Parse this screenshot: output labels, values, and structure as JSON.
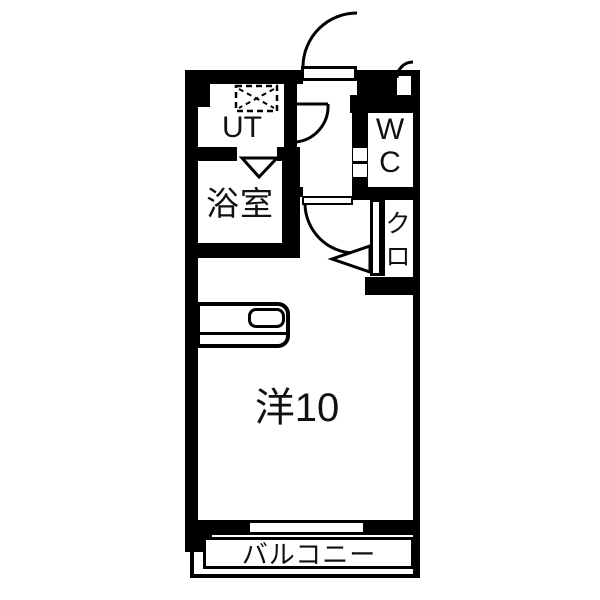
{
  "colors": {
    "wall": "#000000",
    "background": "#ffffff",
    "text": "#111111"
  },
  "rooms": {
    "utility": {
      "label": "UT"
    },
    "bathroom": {
      "label": "浴室"
    },
    "toilet": {
      "label": "WC",
      "line1": "W",
      "line2": "C"
    },
    "closet": {
      "label": "クロ",
      "line1": "ク",
      "line2": "ロ"
    },
    "western_room": {
      "label": "洋10"
    },
    "balcony": {
      "label": "バルコニー"
    }
  },
  "fixtures": {
    "washer_pan": "dashed-square-with-x",
    "kitchen_counter": "counter-with-sink",
    "entrance_door": "outward-swing-arc",
    "interior_door": "inward-swing-arc",
    "hall_door": "swing-arc",
    "meter_box_door": "small-swing-arc",
    "bath_door_marker": "down-triangle",
    "closet_door_marker": "left-arrow-triangle",
    "window": "double-line-opening"
  }
}
